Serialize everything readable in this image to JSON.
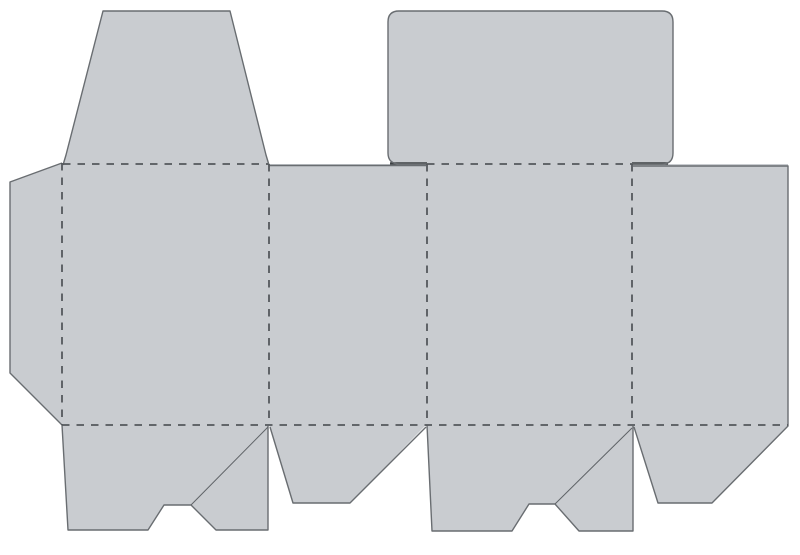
{
  "canvas": {
    "width": 800,
    "height": 555,
    "background": "#ffffff"
  },
  "diagram": {
    "kind": "packaging-box-dieline",
    "colors": {
      "panel_fill": "#c9ccd0",
      "cut_line": "#696d71",
      "accent_line": "#3c4043",
      "fold_line": "#54585c",
      "crease_line": "#5f6367"
    },
    "styles": {
      "cut_width": 1.4,
      "accent_width": 2.4,
      "crease_width": 1,
      "fold_width": 1.8,
      "fold_dash": "7.5 7"
    },
    "fills": [
      {
        "name": "glue-flap-fill",
        "d": "M62,163 L10,182 L10,373 L62,425 Z"
      },
      {
        "name": "main-band-fill",
        "d": "M62,164 L788,164 L788,426 L62,426 Z"
      },
      {
        "name": "tuck-lid-flap-fill",
        "d": "M63,165 L66,155 L103,11 L230,11 L266,155 L269,165 Z"
      },
      {
        "name": "rounded-lid-flap-fill",
        "d": "M400,164 Q388,164 388,153 L388,22 Q388,11 399,11 L662,11 Q673,11 673,22 L673,153 Q673,164 662,164 Z"
      },
      {
        "name": "lock-flap-1-fill",
        "d": "M62,425 L68,530 L148,530 L164,505 L191,505 L216,530 L268,530 L268,425 Z"
      },
      {
        "name": "dust-flap-2-fill",
        "d": "M269,425 L293,503 L350,503 L426,425 Z"
      },
      {
        "name": "lock-flap-3-fill",
        "d": "M427,425 L432,531 L512,531 L529,504 L555,504 L579,531 L633,531 L633,425 Z"
      },
      {
        "name": "dust-flap-4-fill",
        "d": "M633,425 L658,503 L712,503 L788,425 Z"
      }
    ],
    "cut_lines": [
      {
        "name": "glue-flap-cut",
        "d": "M62,163 L10,182 L10,373 L62,425"
      },
      {
        "name": "tuck-lid-flap-cut",
        "d": "M63,165 L66,155 L103,11 L230,11 L266,155 L269,165"
      },
      {
        "name": "rounded-lid-flap-cut",
        "d": "M427,164 L400,164 Q388,164 388,153 L388,22 Q388,11 399,11 L662,11 Q673,11 673,22 L673,153 Q673,164 662,164 L632,164"
      },
      {
        "name": "panel-2-top-cut",
        "d": "M269,165.5 L426,165.5"
      },
      {
        "name": "panel-4-top-right-cut",
        "d": "M633,166 L788,166 L788,426 L712,503 L658,503 L634,427"
      },
      {
        "name": "dust-flap-2-cut",
        "d": "M270,427 L293,503 L350,503 L426,427"
      },
      {
        "name": "lock-flap-1-cut",
        "d": "M62,425 L68,530 L148,530 L164,505 L191,505 L216,530 L268,530 L268,426"
      },
      {
        "name": "lock-flap-3-cut",
        "d": "M427,425 L432,531 L512,531 L529,504 L555,504 L579,531 L633,531 L633,426"
      }
    ],
    "accent_lines": [
      {
        "name": "lid-bottom-left-edge-cut",
        "d": "M390,163.5 L427,163.5"
      },
      {
        "name": "lid-bottom-right-edge-cut",
        "d": "M632,163.5 L668,163.5"
      }
    ],
    "crease_lines": [
      {
        "name": "lock-flap-1-crease",
        "d": "M191,505 L268,427"
      },
      {
        "name": "lock-flap-3-crease",
        "d": "M555,504 L632,428"
      }
    ],
    "fold_lines": [
      {
        "name": "fold-tuck-lid",
        "d": "M63,164 L268,164"
      },
      {
        "name": "fold-rounded-lid",
        "d": "M427,164 L632,164"
      },
      {
        "name": "fold-bottom",
        "d": "M62,425 L788,425"
      },
      {
        "name": "fold-glue-flap",
        "d": "M62,163 L62,425"
      },
      {
        "name": "fold-panel-1-2",
        "d": "M269,164 L269,425"
      },
      {
        "name": "fold-panel-2-3",
        "d": "M427,164 L427,425"
      },
      {
        "name": "fold-panel-3-4",
        "d": "M632,164 L632,425"
      }
    ]
  }
}
